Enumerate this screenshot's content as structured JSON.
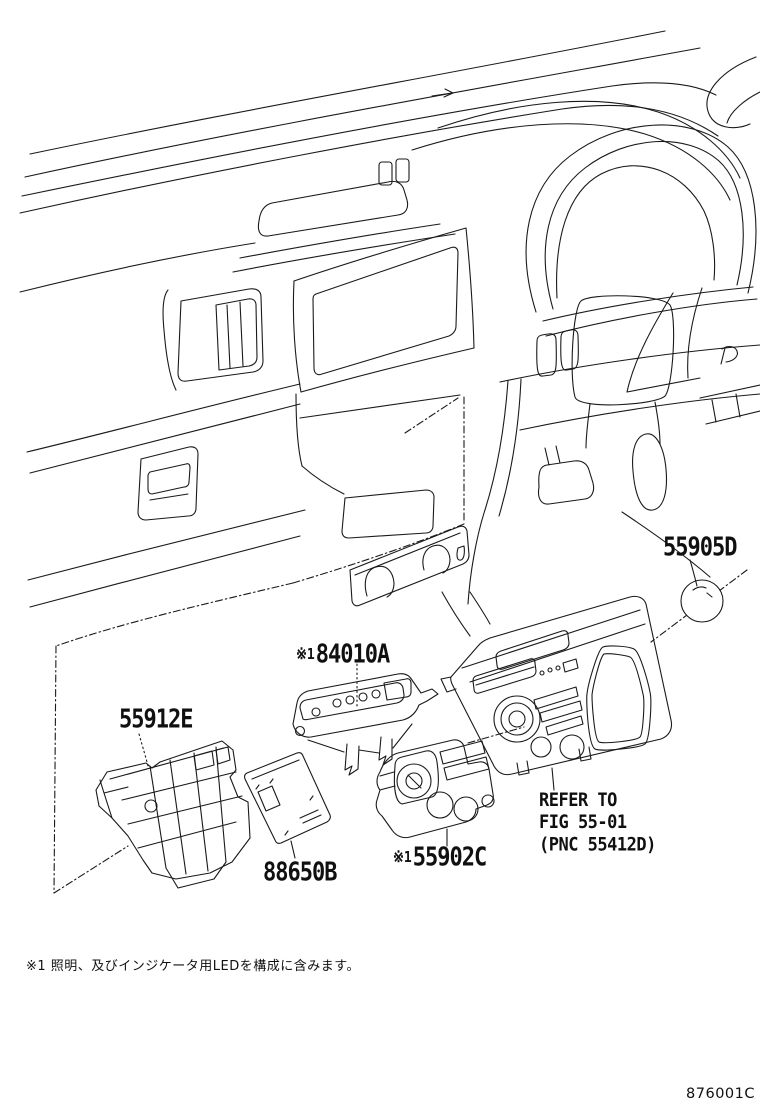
{
  "diagram": {
    "callouts": [
      {
        "id": "55905D",
        "prefix": "",
        "label": "55905D"
      },
      {
        "id": "84010A",
        "prefix": "※1",
        "label": "84010A"
      },
      {
        "id": "55912E",
        "prefix": "",
        "label": "55912E"
      },
      {
        "id": "88650B",
        "prefix": "",
        "label": "88650B"
      },
      {
        "id": "55902C",
        "prefix": "※1",
        "label": "55902C"
      }
    ],
    "reference_note": {
      "line1": "REFER TO",
      "line2": "FIG 55-01",
      "line3": "(PNC 55412D)"
    },
    "footnote": "※1 照明、及びインジケータ用LEDを構成に含みます。",
    "figure_code": "876001C",
    "colors": {
      "line": "#1a1a1a",
      "background": "#ffffff"
    }
  }
}
